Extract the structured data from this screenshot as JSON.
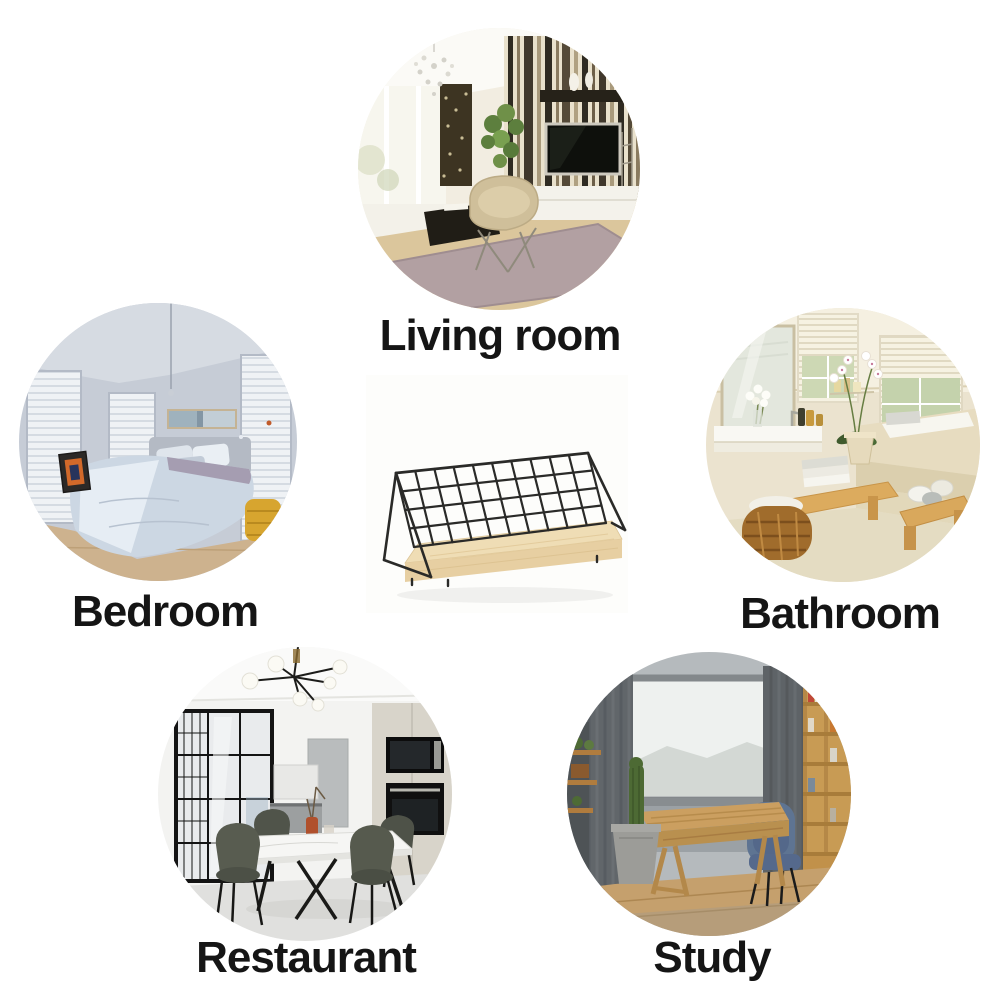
{
  "page": {
    "background_color": "#ffffff",
    "label_color": "#151515"
  },
  "product": {
    "name": "Wire grid wall shelf with wooden base",
    "frame_color": "#2a2a28",
    "wood_color": "#efddb5"
  },
  "rooms": [
    {
      "id": "living-room",
      "label": "Living room"
    },
    {
      "id": "bedroom",
      "label": "Bedroom"
    },
    {
      "id": "bathroom",
      "label": "Bathroom"
    },
    {
      "id": "restaurant",
      "label": "Restaurant"
    },
    {
      "id": "study",
      "label": "Study"
    }
  ]
}
